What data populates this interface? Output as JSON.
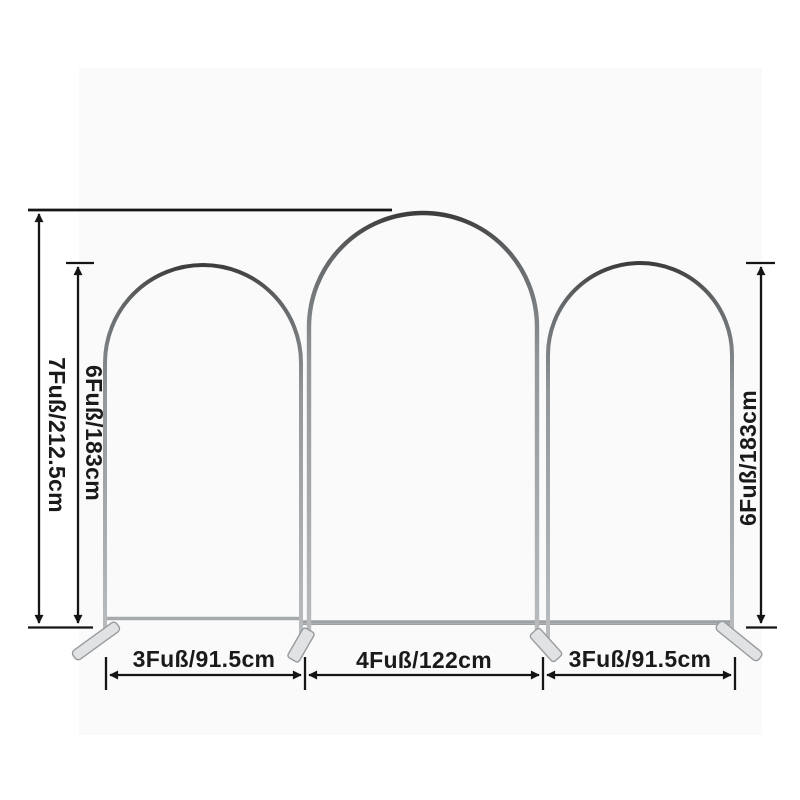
{
  "diagram": {
    "type": "product-dimension-diagram",
    "subject": "set of three arched backdrop stand frames with measurement annotations",
    "colors": {
      "frame_metal": "#9ea2a4",
      "dimension_lines": "#1a1a1a",
      "background": "#ffffff"
    },
    "vertical_dimensions": {
      "total_height": {
        "label": "7Fuß/212.5cm"
      },
      "left_arch_height": {
        "label": "6Fuß/183cm"
      },
      "right_arch_height": {
        "label": "6Fuß/183cm"
      }
    },
    "horizontal_dimensions": {
      "left_arch_width": {
        "label": "3Fuß/91.5cm"
      },
      "middle_arch_width": {
        "label": "4Fuß/122cm"
      },
      "right_arch_width": {
        "label": "3Fuß/91.5cm"
      }
    },
    "arches": [
      {
        "position": "left",
        "height_label": "6Fuß/183cm",
        "width_label": "3Fuß/91.5cm"
      },
      {
        "position": "middle",
        "height_label": "7Fuß/212.5cm",
        "width_label": "4Fuß/122cm"
      },
      {
        "position": "right",
        "height_label": "6Fuß/183cm",
        "width_label": "3Fuß/91.5cm"
      }
    ]
  }
}
